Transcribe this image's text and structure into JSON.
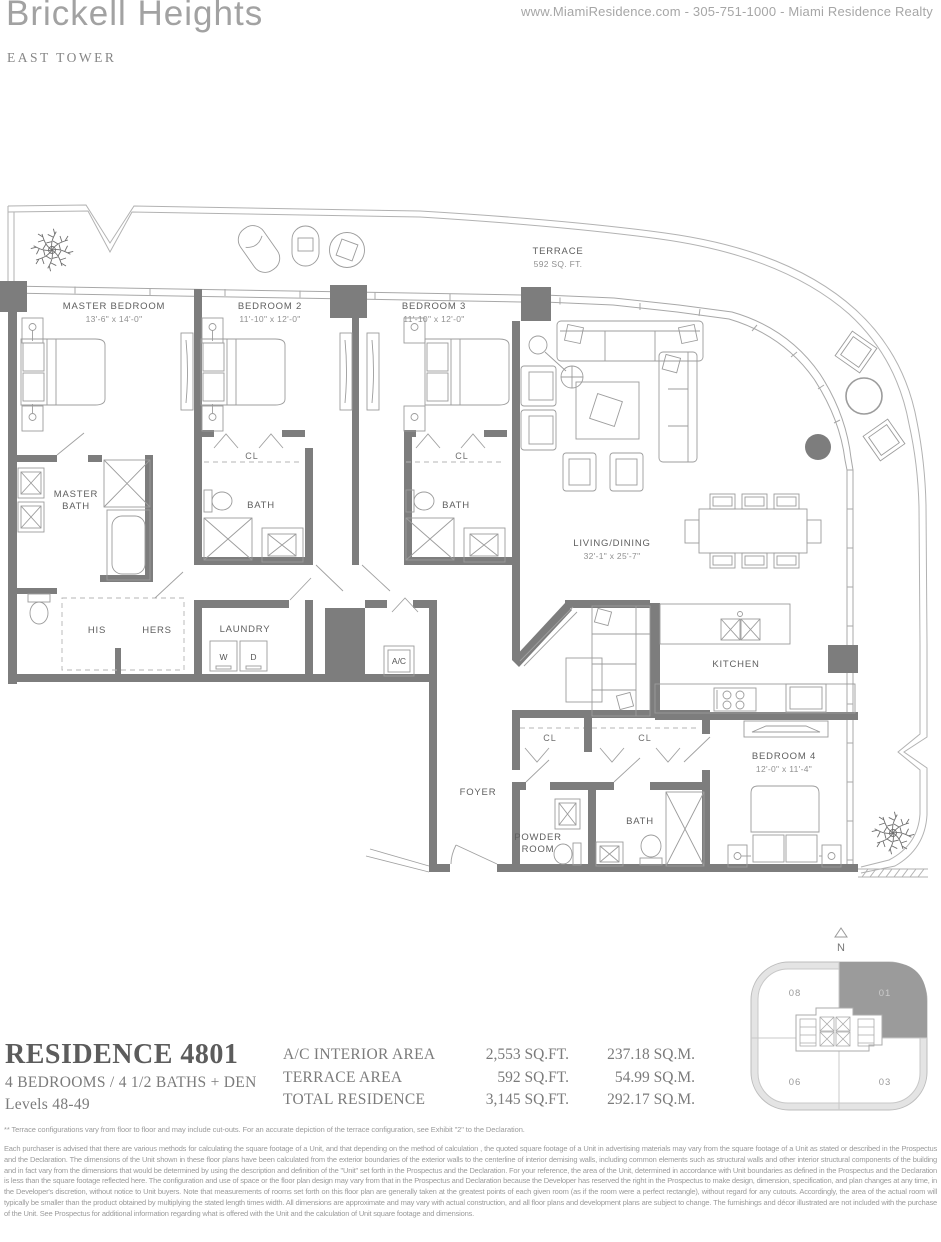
{
  "colors": {
    "wall_gray": "#7d7d7d",
    "line_gray": "#a8a8a8",
    "keyplan_highlight_gray": "#9b9b9b"
  },
  "header": {
    "title": "Brickell Heights",
    "subtitle": "EAST TOWER",
    "contact": "www.MiamiResidence.com  -  305-751-1000  -  Miami Residence Realty"
  },
  "plan": {
    "terrace": {
      "name": "TERRACE",
      "area": "592 SQ. FT."
    },
    "master_bedroom": {
      "name": "MASTER BEDROOM",
      "dims": "13'-6\" x 14'-0\""
    },
    "bedroom_2": {
      "name": "BEDROOM 2",
      "dims": "11'-10\" x 12'-0\""
    },
    "bedroom_3": {
      "name": "BEDROOM 3",
      "dims": "11'-10\" x 12'-0\""
    },
    "living_dining": {
      "name": "LIVING/DINING",
      "dims": "32'-1\" x 25'-7\""
    },
    "bedroom_4": {
      "name": "BEDROOM 4",
      "dims": "12'-0\" x 11'-4\""
    },
    "kitchen": "KITCHEN",
    "master_bath_1": "MASTER",
    "master_bath_2": "BATH",
    "bath": "BATH",
    "his": "HIS",
    "hers": "HERS",
    "laundry": "LAUNDRY",
    "washer": "W",
    "dryer": "D",
    "ac": "A/C",
    "foyer": "FOYER",
    "powder_1": "POWDER",
    "powder_2": "ROOM",
    "closet": "CL"
  },
  "keyplan": {
    "north": "N",
    "unit_top_left": "08",
    "unit_top_right": "01",
    "unit_bottom_left": "06",
    "unit_bottom_right": "03"
  },
  "residence": {
    "name": "RESIDENCE 4801",
    "config": "4 BEDROOMS / 4 1/2 BATHS + DEN",
    "levels": "Levels 48-49",
    "areas": [
      {
        "label": "A/C INTERIOR AREA",
        "sqft": "2,553 SQ.FT.",
        "sqm": "237.18 SQ.M."
      },
      {
        "label": "TERRACE AREA",
        "sqft": "592 SQ.FT.",
        "sqm": "54.99 SQ.M."
      },
      {
        "label": "TOTAL RESIDENCE",
        "sqft": "3,145 SQ.FT.",
        "sqm": "292.17 SQ.M."
      }
    ]
  },
  "disclaimer": {
    "footnote": "** Terrace configurations vary from floor to floor and may include cut-outs.  For an accurate depiction of the terrace configuration, see Exhibit \"2\" to the Declaration.",
    "body": "Each purchaser is advised that there are various methods for calculating the square footage of a Unit, and that depending on the method of calculation , the quoted square footage of a Unit in advertising materials may vary from the square footage of a Unit as stated or described in the Prospectus and the Declaration.  The dimensions of the Unit shown in these floor plans have been calculated from the exterior boundaries of the exterior walls to the centerline of interior demising walls, including common elements such as structural walls and other interior structural components of the building and in fact vary from the dimensions that would be determined by using the description and definition of the \"Unit\" set forth in the Prospectus and the Declaration.  For your reference, the area of the Unit, determined in accordance with Unit boundaries as defined in the Prospectus and the Declaration is less than the square footage reflected here. The configuration and use of space or the floor plan design may vary from that in the Prospectus and Declaration because the Developer has reserved the right in the Prospectus to make design, dimension, specification, and plan changes at any time, in the Developer's discretion, without notice to Unit buyers. Note that measurements of rooms set forth on this floor plan are generally taken at the greatest points of each given room (as if the room were a perfect rectangle), without regard for any cutouts.  Accordingly, the area of the actual room will typically be smaller than the product obtained by multiplying the stated length times width.  All dimensions are approximate and may vary with actual construction, and all floor plans and development plans are subject to change.  The furnishings and décor illustrated are not included with the purchase of the Unit. See Prospectus for additional information regarding what is offered with the Unit and the calculation of Unit square footage and dimensions."
  }
}
